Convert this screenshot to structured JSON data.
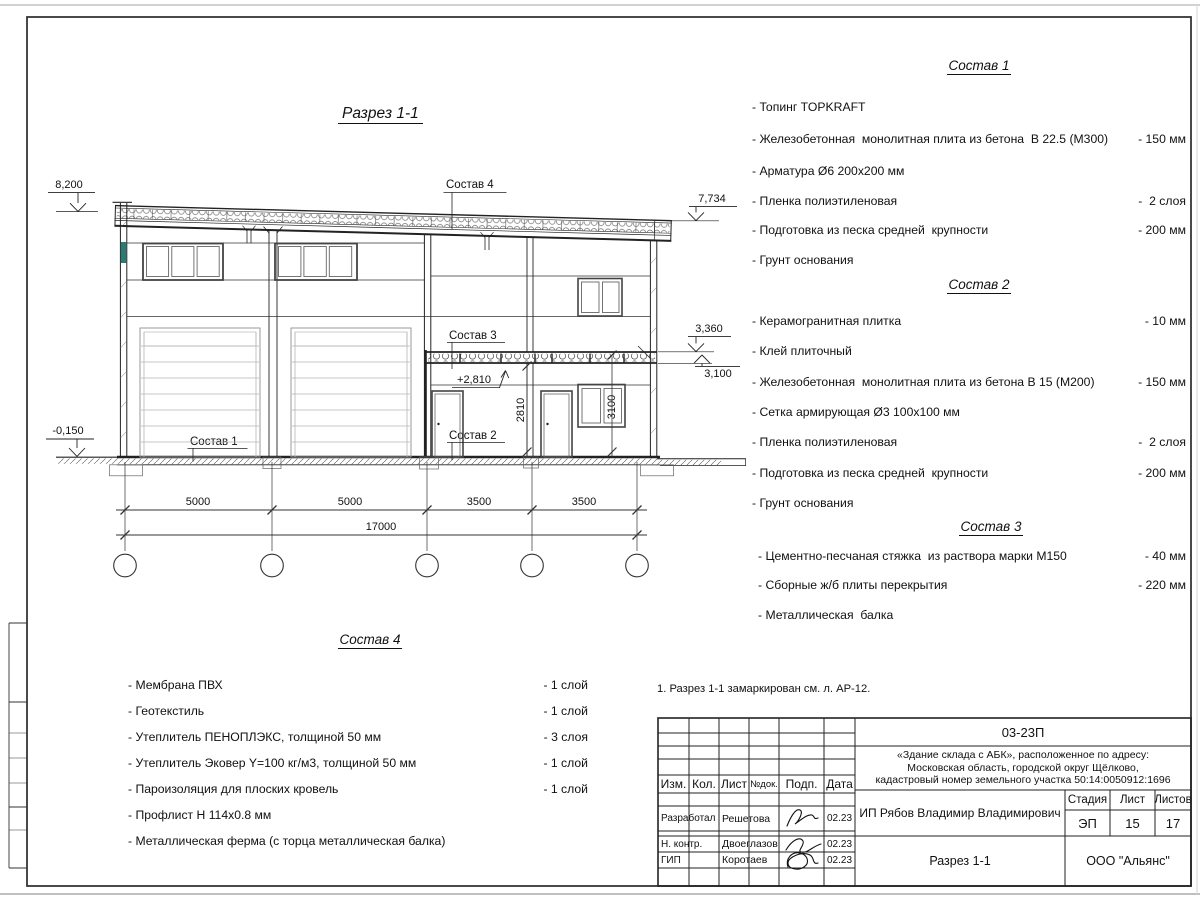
{
  "sheet": {
    "drawing_title": "Разрез 1-1",
    "note": "1. Разрез 1-1 замаркирован см. л. АР-12."
  },
  "compositions": [
    {
      "title": "Состав 1",
      "items": [
        {
          "text": "- Топинг TOPKRAFT",
          "value": ""
        },
        {
          "text": "- Железобетонная  монолитная плита из бетона  В 22.5 (М300)",
          "value": "- 150 мм"
        },
        {
          "text": "- Арматура Ø6 200x200 мм",
          "value": ""
        },
        {
          "text": "- Пленка полиэтиленовая",
          "value": "-  2 слоя"
        },
        {
          "text": "- Подготовка из песка средней  крупности",
          "value": "- 200 мм"
        },
        {
          "text": "- Грунт основания",
          "value": ""
        }
      ]
    },
    {
      "title": "Состав 2",
      "items": [
        {
          "text": "- Керамогранитная плитка",
          "value": "- 10 мм"
        },
        {
          "text": "- Клей плиточный",
          "value": ""
        },
        {
          "text": "- Железобетонная  монолитная плита из бетона В 15 (М200)",
          "value": "- 150 мм"
        },
        {
          "text": "- Сетка армирующая Ø3 100x100 мм",
          "value": ""
        },
        {
          "text": "- Пленка полиэтиленовая",
          "value": "-  2 слоя"
        },
        {
          "text": "- Подготовка из песка средней  крупности",
          "value": "- 200 мм"
        },
        {
          "text": "- Грунт основания",
          "value": ""
        }
      ]
    },
    {
      "title": "Состав 3",
      "items": [
        {
          "text": "- Цементно-песчаная стяжка  из раствора марки М150",
          "value": "- 40 мм"
        },
        {
          "text": "- Сборные ж/б плиты перекрытия",
          "value": "- 220 мм"
        },
        {
          "text": "- Металлическая  балка",
          "value": ""
        }
      ]
    },
    {
      "title": "Состав 4",
      "items": [
        {
          "text": "- Мембрана ПВХ",
          "value": "- 1 слой"
        },
        {
          "text": "- Геотекстиль",
          "value": "- 1 слой"
        },
        {
          "text": "- Утеплитель ПЕНОПЛЭКС, толщиной 50 мм",
          "value": "- 3 слоя"
        },
        {
          "text": "- Утеплитель Эковер Y=100 кг/м3, толщиной 50 мм",
          "value": "- 1 слой"
        },
        {
          "text": "- Пароизоляция для плоских кровель",
          "value": "- 1 слой"
        },
        {
          "text": "- Профлист Н 114x0.8 мм",
          "value": ""
        },
        {
          "text": "- Металлическая ферма (с торца металлическая балка)",
          "value": ""
        }
      ]
    }
  ],
  "section": {
    "labels": {
      "s1": "Состав  1",
      "s2": "Состав  2",
      "s3": "Состав  3",
      "s4": "Состав 4"
    },
    "elevations": {
      "left_top": "8,200",
      "left_ground": "-0,150",
      "right_top": "7,734",
      "slab_upper": "3,360",
      "slab_lower": "3,100",
      "floor2": "+2,810"
    },
    "vertical_dims": {
      "d2810": "2810",
      "d3100": "3100"
    },
    "dims": [
      "5000",
      "5000",
      "3500",
      "3500"
    ],
    "dim_total": "17000",
    "axes": [
      "А",
      "Б",
      "В",
      "Г",
      "Д"
    ]
  },
  "title_block": {
    "doc_number": "03-23П",
    "project": "«Здание склада с АБК», расположенное по адресу:",
    "project2": "Московская область, городской округ Щёлково,",
    "project3": "кадастровый номер земельного участка 50:14:0050912:1696",
    "client": "ИП Рябов Владимир Владимирович",
    "sheet_title": "Разрез 1-1",
    "company": "ООО \"Альянс\"",
    "stage_label": "Стадия",
    "stage": "ЭП",
    "sheet_label": "Лист",
    "sheet_no": "15",
    "sheets_label": "Листов",
    "sheets_total": "17",
    "cols": {
      "izm": "Изм.",
      "kol": "Кол.",
      "list": "Лист",
      "ndok": "№док.",
      "podp": "Подп.",
      "data": "Дата"
    },
    "rows": [
      {
        "role": "Разработал",
        "name": "Решетова",
        "date": "02.23"
      },
      {
        "role": "Н. контр.",
        "name": "Двоеглазов",
        "date": "02.23"
      },
      {
        "role": "ГИП",
        "name": "Коротаев",
        "date": "02.23"
      }
    ]
  }
}
